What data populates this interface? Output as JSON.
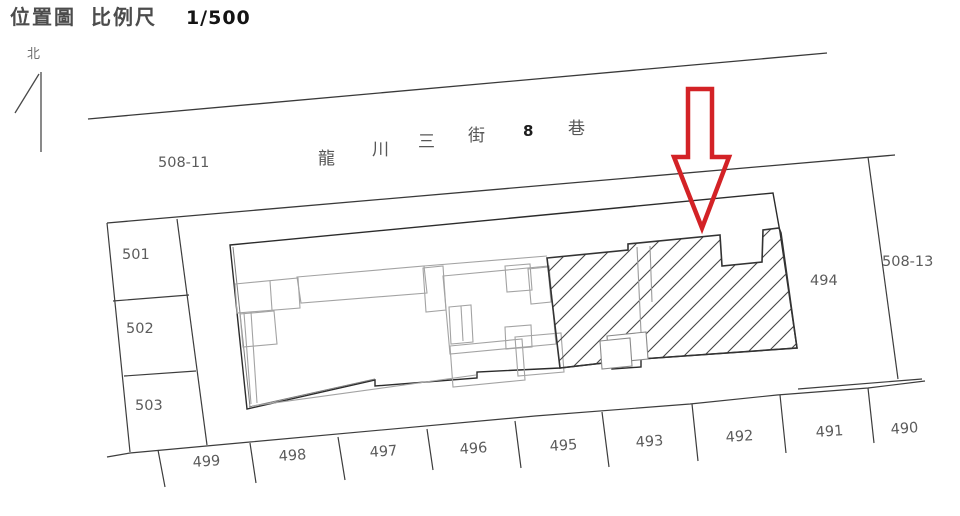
{
  "header": {
    "map_title": "位置圖",
    "scale_label": "比例尺",
    "scale_value": "1/500"
  },
  "compass": {
    "north_label": "北"
  },
  "street": {
    "name": "龍川三街8巷",
    "chars": [
      "龍",
      "川",
      "三",
      "街",
      "8",
      "巷"
    ]
  },
  "parcels": {
    "road_parcel": "508-11",
    "side_parcel": "508-13",
    "left_column": [
      "501",
      "502",
      "503"
    ],
    "right_parcel": "494",
    "bottom_row": [
      "499",
      "498",
      "497",
      "496",
      "495",
      "493",
      "492",
      "491",
      "490"
    ]
  },
  "colors": {
    "highlight_arrow": "#d32226",
    "drawing_line": "#3a3a3a",
    "building_line": "#a3a3a3",
    "label_text": "#5c5c5c"
  }
}
